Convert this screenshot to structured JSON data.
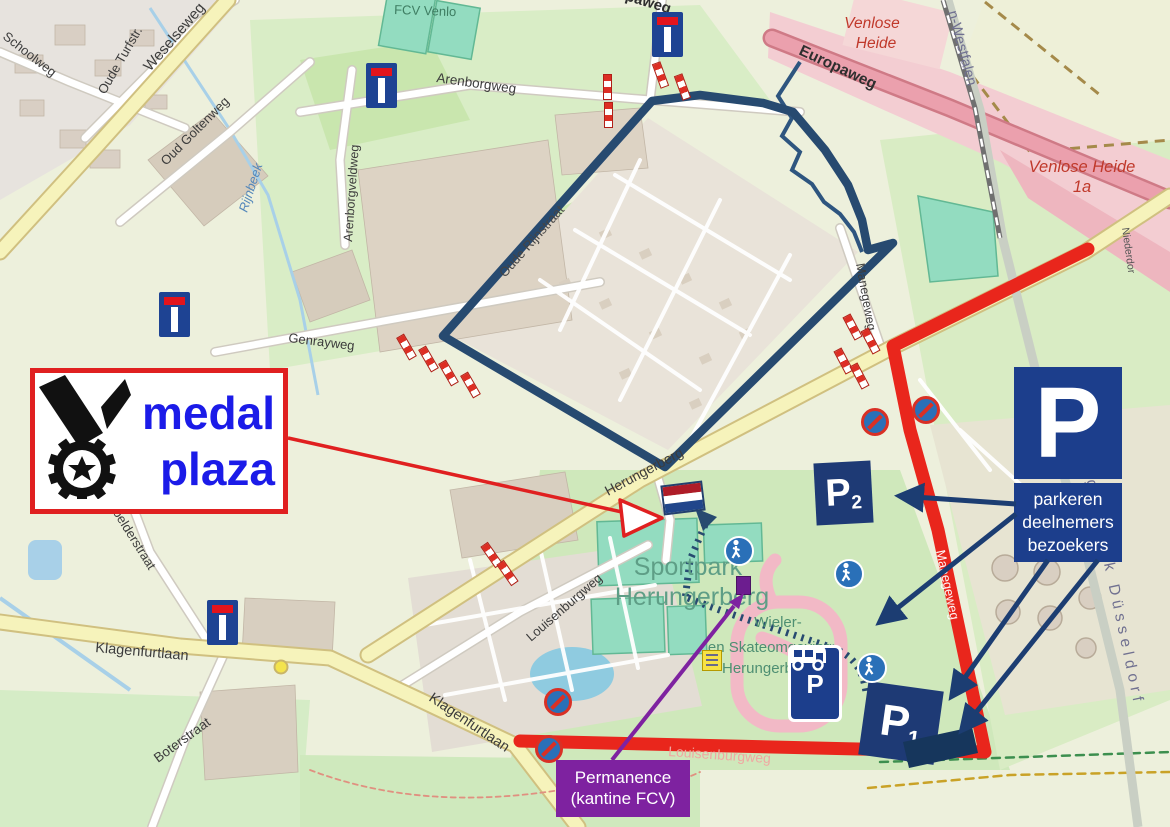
{
  "overlay": {
    "medal_plaza": {
      "line1": "medal",
      "line2": "plaza"
    },
    "parking_sign": {
      "letter": "P",
      "line1": "parkeren",
      "line2": "deelnemers",
      "line3": "bezoekers"
    },
    "p1": {
      "letter": "P",
      "sub": "1"
    },
    "p2": {
      "letter": "P",
      "sub": "2"
    },
    "camper": {
      "letter": "P"
    },
    "permanence": {
      "line1": "Permanence",
      "line2": "(kantine FCV)"
    }
  },
  "streets": {
    "weselseweg": "Weselseweg",
    "schoolweg": "Schoolweg",
    "oude_turfstraat": "Oude Turfstr.",
    "arenborgweg": "Arenborgweg",
    "arenborgveldweg": "Arenborgveldweg",
    "oud_goltenweg": "Oud Goltenweg",
    "genrayweg": "Genrayweg",
    "rijnbeek": "Rijnbeek",
    "koelderstraat": "Koelderstraat",
    "klagenfurtlaan": "Klagenfurtlaan",
    "boterstraat": "Boterstraat",
    "louisenburgweg": "Louisenburgweg",
    "herungerberg": "Herungerberg",
    "europaweg": "Europaweg",
    "manegeweg": "Manegeweg",
    "oude_rijnstraat": "Oude Rijnstraat",
    "niederdor": "Niederdor"
  },
  "places": {
    "fcv_venlo": "FCV Venlo",
    "venlose_heide": {
      "line1": "Venlose",
      "line2": "Heide"
    },
    "venlose_heide_1a": {
      "line1": "Venlose Heide",
      "line2": "1a"
    },
    "sportpark": {
      "line1": "Sportpark",
      "line2": "Herungerberg"
    },
    "wieler": {
      "line1": "Wieler-",
      "line2": "en Skateomgeving",
      "line3": "Herungerberg"
    },
    "n_westfalen": "n-Westfalen",
    "regierungsbezirk": "Regierungsbezirk Düsseldorf"
  },
  "colors": {
    "route_red": "#e9261c",
    "course_navy": "#274a70",
    "arrow_navy": "#1c3d72",
    "sign_blue": "#1c3e8c",
    "permanence_purple": "#7e22a0",
    "medal_text_blue": "#1b1be8"
  }
}
